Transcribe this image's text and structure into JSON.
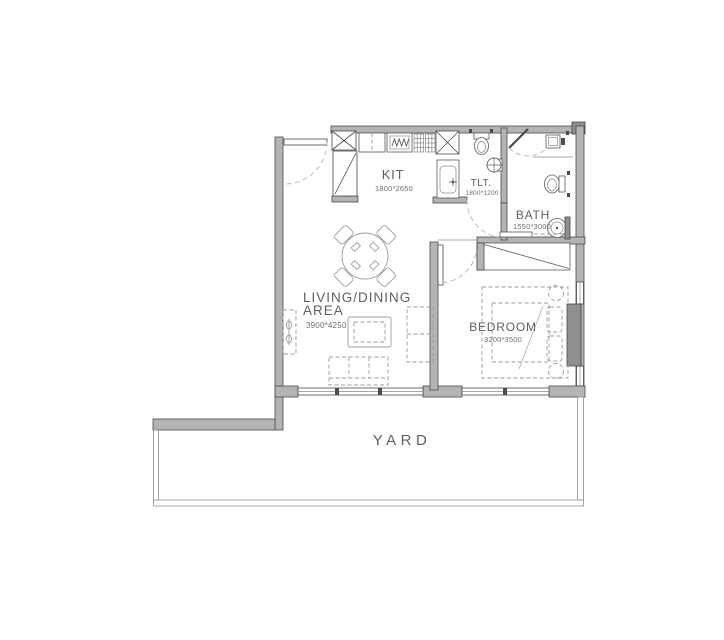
{
  "rooms": {
    "kit": {
      "label": "KIT",
      "dims": "1800*2650"
    },
    "tlt": {
      "label": "TLT.",
      "dims": "1800*1200"
    },
    "bath": {
      "label": "BATH",
      "dims": "1550*3000"
    },
    "living": {
      "line1": "LIVING/DINING",
      "line2": "AREA",
      "dims": "3900*4250"
    },
    "bedroom": {
      "label": "BEDROOM",
      "dims": "3200*3500"
    },
    "yard": {
      "label": "YARD"
    }
  },
  "colors": {
    "background": "#ffffff",
    "wall_fill": "#b4b4b4",
    "wall_dark": "#8f8f8f",
    "wall_outline": "#4a4a4a",
    "furniture_stroke": "#9c9c9c",
    "door_arc": "#b3b3b3",
    "yard_boundary": "#9b9b9b",
    "text": "#5c6064"
  }
}
